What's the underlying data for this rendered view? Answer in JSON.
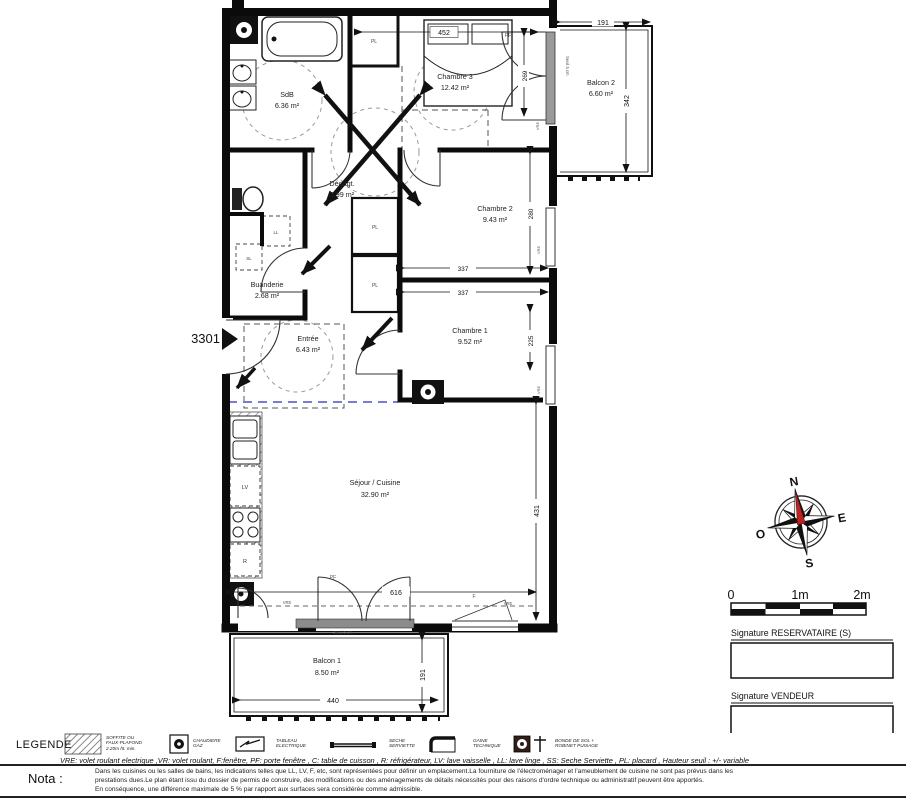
{
  "plan": {
    "unit": "3301",
    "rooms": {
      "sdb": {
        "name": "SdB",
        "area": "6.36 m²"
      },
      "ch3": {
        "name": "Chambre 3",
        "area": "12.42 m²"
      },
      "balcon2": {
        "name": "Balcon 2",
        "area": "6.60 m²"
      },
      "degagt": {
        "name": "Dégagt.",
        "area": "3.99 m²"
      },
      "ch2": {
        "name": "Chambre 2",
        "area": "9.43 m²"
      },
      "buanderie": {
        "name": "Buanderie",
        "area": "2.68 m²"
      },
      "entree": {
        "name": "Entrée",
        "area": "6.43 m²"
      },
      "ch1": {
        "name": "Chambre 1",
        "area": "9.52 m²"
      },
      "sejour": {
        "name": "Séjour / Cuisine",
        "area": "32.90 m²"
      },
      "balcon1": {
        "name": "Balcon 1",
        "area": "8.50 m²"
      }
    },
    "dims": {
      "d452": "452",
      "d191a": "191",
      "d342": "342",
      "d269": "269",
      "d280": "280",
      "d337a": "337",
      "d337b": "337",
      "d225": "225",
      "d431": "431",
      "d616": "616",
      "d440": "440",
      "d191b": "191"
    },
    "tags": {
      "pl": "PL",
      "ll": "LL",
      "sl": "SL",
      "lv": "LV",
      "r": "R",
      "f": "F",
      "pf": "PF",
      "vre": "VRE",
      "seuil": "Seuil 5 cm"
    }
  },
  "compass": {
    "n": "N",
    "e": "E",
    "s": "S",
    "o": "O"
  },
  "scale": {
    "t0": "0",
    "t1": "1m",
    "t2": "2m"
  },
  "signatures": {
    "reservataire": "Signature RESERVATAIRE (S)",
    "vendeur": "Signature VENDEUR"
  },
  "legend": {
    "title": "LEGENDE",
    "soffite": {
      "l1": "SOFFITE OU",
      "l2": "FAUX-PLAFOND",
      "l3": "2.20m ht. min."
    },
    "chaudiere": {
      "l1": "CHAUDIERE",
      "l2": "GAZ"
    },
    "tableau": {
      "l1": "TABLEAU",
      "l2": "ELECTRIQUE"
    },
    "seche": {
      "l1": "SECHE",
      "l2": "SERVIETTE"
    },
    "gaine": {
      "l1": "GAINE",
      "l2": "TECHNIQUE"
    },
    "bonde": {
      "l1": "BONDE DE SOL +",
      "l2": "ROBINET PUISAGE"
    },
    "abbreviations": "VRE: volet roulant electrique ,VR: volet roulant, F:fenêtre, PF: porte fenêtre , C: table de cuisson , R: réfrigérateur, LV: lave vaisselle , LL: lave linge , SS: Seche Serviette , PL: placard , Hauteur seuil : +/- variable"
  },
  "nota": {
    "label": "Nota :",
    "line1": "Dans les cuisines ou les salles de bains, les indications telles que LL, LV, F, etc, sont représentées pour définir un emplacement.La fourniture de l'électroménager et l'ameublement de cuisine ne sont pas prévus dans les",
    "line2": "prestations dues.Le plan étant issu du dossier de permis de construire, des modifications ou des aménagements de détails nécessités pour des raisons d'ordre technique ou administratif peuvent être apportés.",
    "line3": "En conséquence, une différence maximale de 5 % par rapport aux surfaces sera considérée comme admissible."
  }
}
